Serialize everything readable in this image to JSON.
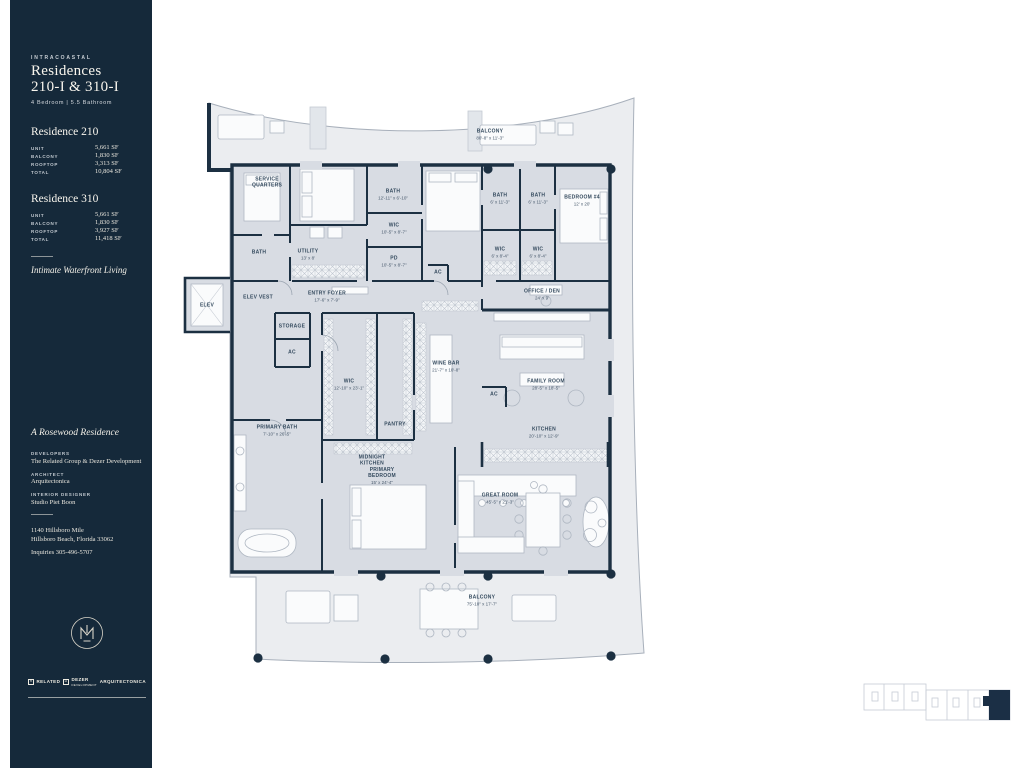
{
  "sidebar": {
    "eyebrow": "INTRACOASTAL",
    "title_line1": "Residences",
    "title_line2": "210-I & 310-I",
    "subtitle": "4 Bedroom   |   5.5 Bathroom",
    "residences": [
      {
        "name": "Residence 210",
        "rows": [
          {
            "label": "UNIT",
            "value": "5,661 SF"
          },
          {
            "label": "BALCONY",
            "value": "1,830 SF"
          },
          {
            "label": "ROOFTOP",
            "value": "3,313 SF"
          },
          {
            "label": "TOTAL",
            "value": "10,804 SF"
          }
        ]
      },
      {
        "name": "Residence 310",
        "rows": [
          {
            "label": "UNIT",
            "value": "5,661 SF"
          },
          {
            "label": "BALCONY",
            "value": "1,830 SF"
          },
          {
            "label": "ROOFTOP",
            "value": "3,927 SF"
          },
          {
            "label": "TOTAL",
            "value": "11,418 SF"
          }
        ]
      }
    ],
    "tagline": "Intimate Waterfront Living",
    "brand_line": "A Rosewood Residence",
    "credits": [
      {
        "label": "DEVELOPERS",
        "value": "The Related Group & Dezer Development"
      },
      {
        "label": "ARCHITECT",
        "value": "Arquitectonica"
      },
      {
        "label": "INTERIOR DESIGNER",
        "value": "Studio Piet Boon"
      }
    ],
    "address_line1": "1140 Hillsboro Mile",
    "address_line2": "Hillsboro Beach, Florida 33062",
    "inquiries": "Inquiries  305-496-5707",
    "partners": [
      {
        "name": "RELATED",
        "icon": "related-square-icon"
      },
      {
        "name": "DEZER",
        "sub": "DEVELOPMENT",
        "icon": "dezer-square-icon"
      },
      {
        "name": "ARQUITECTONICA",
        "icon": ""
      }
    ]
  },
  "floorplan": {
    "rooms": [
      {
        "label": "SERVICE QUARTERS",
        "dims": "",
        "x": 85,
        "y": 88
      },
      {
        "label": "BATH",
        "dims": "",
        "x": 77,
        "y": 158
      },
      {
        "label": "UTILITY",
        "dims": "13' x 8'",
        "x": 126,
        "y": 160
      },
      {
        "label": "BATH",
        "dims": "12'-11\" x 6'-10\"",
        "x": 211,
        "y": 100
      },
      {
        "label": "WIC",
        "dims": "10'-5\" x 8'-7\"",
        "x": 212,
        "y": 134
      },
      {
        "label": "PD",
        "dims": "10'-5\" x 8'-7\"",
        "x": 212,
        "y": 167
      },
      {
        "label": "BATH",
        "dims": "6' x 11'-3\"",
        "x": 318,
        "y": 104
      },
      {
        "label": "BATH",
        "dims": "6' x 11'-3\"",
        "x": 356,
        "y": 104
      },
      {
        "label": "BEDROOM #4",
        "dims": "12' x 20'",
        "x": 400,
        "y": 106
      },
      {
        "label": "WIC",
        "dims": "6' x 8'-4\"",
        "x": 318,
        "y": 158
      },
      {
        "label": "WIC",
        "dims": "6' x 8'-4\"",
        "x": 356,
        "y": 158
      },
      {
        "label": "AC",
        "dims": "",
        "x": 256,
        "y": 178
      },
      {
        "label": "ELEV",
        "dims": "",
        "x": 25,
        "y": 211
      },
      {
        "label": "ELEV VEST",
        "dims": "",
        "x": 76,
        "y": 203
      },
      {
        "label": "ENTRY FOYER",
        "dims": "17'-6\" x 7'-9\"",
        "x": 145,
        "y": 202
      },
      {
        "label": "STORAGE",
        "dims": "",
        "x": 110,
        "y": 232
      },
      {
        "label": "AC",
        "dims": "",
        "x": 110,
        "y": 258
      },
      {
        "label": "WIC",
        "dims": "12'-10\" x 23'-1\"",
        "x": 167,
        "y": 290
      },
      {
        "label": "PANTRY",
        "dims": "",
        "x": 213,
        "y": 330
      },
      {
        "label": "PRIMARY BATH",
        "dims": "7'-10\" x 26'-5\"",
        "x": 95,
        "y": 336
      },
      {
        "label": "OFFICE / DEN",
        "dims": "24' x 9'",
        "x": 360,
        "y": 200
      },
      {
        "label": "WINE BAR",
        "dims": "21'-7\" x 10'-8\"",
        "x": 264,
        "y": 272
      },
      {
        "label": "FAMILY ROOM",
        "dims": "28'-5\" x 18'-5\"",
        "x": 364,
        "y": 290
      },
      {
        "label": "AC",
        "dims": "",
        "x": 312,
        "y": 300
      },
      {
        "label": "KITCHEN",
        "dims": "20'-10\" x 12'-9\"",
        "x": 362,
        "y": 338
      },
      {
        "label": "MIDNIGHT KITCHEN",
        "dims": "",
        "x": 190,
        "y": 366
      },
      {
        "label": "PRIMARY BEDROOM",
        "dims": "15' x 24'-4\"",
        "x": 200,
        "y": 381
      },
      {
        "label": "GREAT ROOM",
        "dims": "45'-5\" x 21'-3\"",
        "x": 318,
        "y": 404
      },
      {
        "label": "BALCONY",
        "dims": "80'-8\" x 11'-3\"",
        "x": 308,
        "y": 40
      },
      {
        "label": "BALCONY",
        "dims": "75'-10\" x 17'-7\"",
        "x": 300,
        "y": 506
      }
    ]
  },
  "colors": {
    "sidebar_bg": "#15293A",
    "wall": "#1C3042",
    "unit_floor": "#D8DCE3",
    "balcony": "#EBEDF0",
    "label_text": "#344A5E",
    "cream_text": "#EFECE2"
  }
}
